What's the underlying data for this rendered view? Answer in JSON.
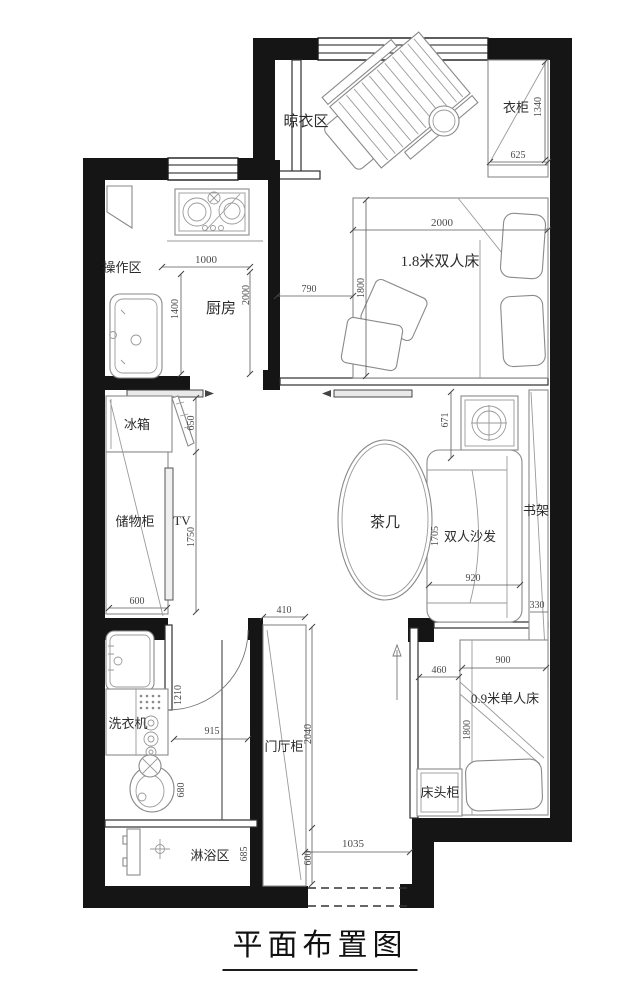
{
  "title": "平面布置图",
  "labels": {
    "drying_area": "晾衣区",
    "wardrobe": "衣柜",
    "prep_area": "操作区",
    "kitchen": "厨房",
    "double_bed": "1.8米双人床",
    "fridge": "冰箱",
    "storage_cabinet": "储物柜",
    "tv": "TV",
    "tea_table": "茶几",
    "double_sofa": "双人沙发",
    "bookshelf": "书架",
    "washing_machine": "洗衣机",
    "shower_area": "淋浴区",
    "hall_cabinet": "门厅柜",
    "bedside_table": "床头柜",
    "single_bed": "0.9米单人床"
  },
  "dimensions": {
    "wardrobe_depth": "1340",
    "wardrobe_width": "625",
    "double_bed_width": "2000",
    "double_bed_length": "1800",
    "bed_side_gap": "790",
    "kitchen_width": "1000",
    "kitchen_length": "2000",
    "kitchen_counter": "1400",
    "fridge_depth": "650",
    "storage_length": "1750",
    "storage_width": "600",
    "sofa_wall_gap": "671",
    "sofa_width": "920",
    "sofa_length": "1705",
    "bookshelf_depth": "330",
    "hall_cabinet_width": "410",
    "hall_cabinet_length": "2040",
    "hall_cabinet_bottom": "600",
    "entry_width": "1035",
    "bath_door": "1210",
    "hall_width": "915",
    "toilet_width": "680",
    "shower_depth": "685",
    "single_bed_gap": "460",
    "single_bed_width": "900",
    "single_bed_length": "1800"
  },
  "colors": {
    "wall": "#151515",
    "furniture_line": "#8a8a8a",
    "dimension": "#4a4a4a"
  }
}
